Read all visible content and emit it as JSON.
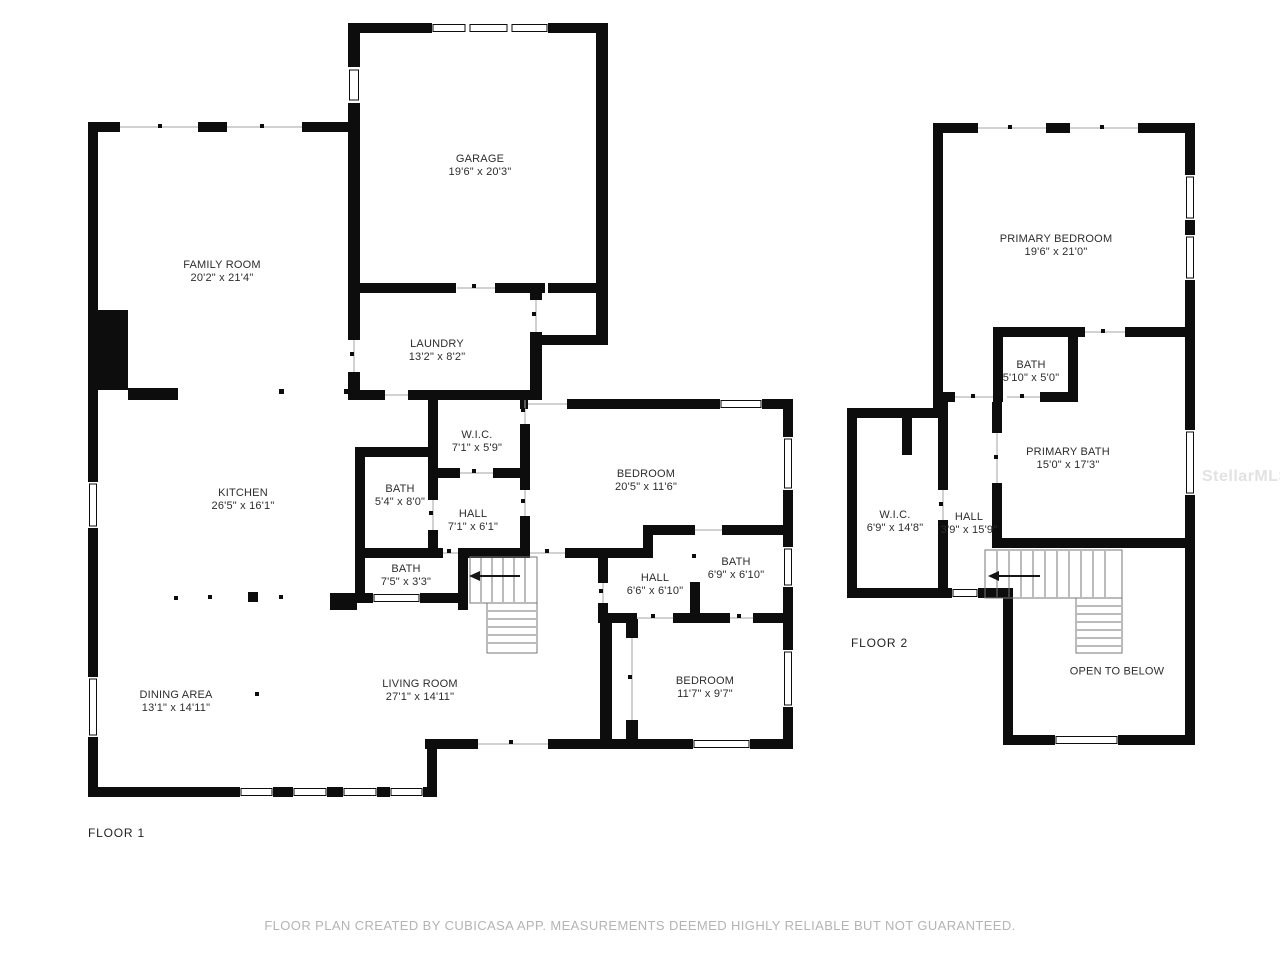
{
  "colors": {
    "wall": "#0d0d0d",
    "thin_line": "#a6a6a6",
    "stair_line": "#777777",
    "label": "#2d2d2d",
    "footer": "#b4b4b4",
    "watermark": "#e2e2e2"
  },
  "watermark": {
    "text": "StellarMLS"
  },
  "footer": {
    "disclaimer": "FLOOR PLAN CREATED BY CUBICASA APP. MEASUREMENTS DEEMED HIGHLY RELIABLE BUT NOT GUARANTEED."
  },
  "floor1": {
    "label": "FLOOR 1",
    "rooms": [
      {
        "id": "garage",
        "name": "GARAGE",
        "dims": "19'6\" x 20'3\"",
        "cx": 480,
        "cy": 166
      },
      {
        "id": "family-room",
        "name": "FAMILY ROOM",
        "dims": "20'2\" x 21'4\"",
        "cx": 222,
        "cy": 272
      },
      {
        "id": "laundry",
        "name": "LAUNDRY",
        "dims": "13'2\" x 8'2\"",
        "cx": 437,
        "cy": 351
      },
      {
        "id": "wic",
        "name": "W.I.C.",
        "dims": "7'1\" x 5'9\"",
        "cx": 477,
        "cy": 442
      },
      {
        "id": "kitchen",
        "name": "KITCHEN",
        "dims": "26'5\" x 16'1\"",
        "cx": 243,
        "cy": 500
      },
      {
        "id": "bath-1",
        "name": "BATH",
        "dims": "5'4\" x 8'0\"",
        "cx": 400,
        "cy": 496
      },
      {
        "id": "hall-1",
        "name": "HALL",
        "dims": "7'1\" x 6'1\"",
        "cx": 473,
        "cy": 521
      },
      {
        "id": "bedroom-1",
        "name": "BEDROOM",
        "dims": "20'5\" x 11'6\"",
        "cx": 646,
        "cy": 481
      },
      {
        "id": "bath-2",
        "name": "BATH",
        "dims": "7'5\" x 3'3\"",
        "cx": 406,
        "cy": 576
      },
      {
        "id": "hall-2",
        "name": "HALL",
        "dims": "6'6\" x 6'10\"",
        "cx": 655,
        "cy": 585
      },
      {
        "id": "bath-3",
        "name": "BATH",
        "dims": "6'9\" x 6'10\"",
        "cx": 736,
        "cy": 569
      },
      {
        "id": "bedroom-2",
        "name": "BEDROOM",
        "dims": "11'7\" x 9'7\"",
        "cx": 705,
        "cy": 688
      },
      {
        "id": "living-room",
        "name": "LIVING ROOM",
        "dims": "27'1\" x 14'11\"",
        "cx": 420,
        "cy": 691
      },
      {
        "id": "dining-area",
        "name": "DINING AREA",
        "dims": "13'1\" x 14'11\"",
        "cx": 176,
        "cy": 702
      }
    ]
  },
  "floor2": {
    "label": "FLOOR 2",
    "rooms": [
      {
        "id": "primary-bedroom",
        "name": "PRIMARY BEDROOM",
        "dims": "19'6\" x 21'0\"",
        "cx": 1056,
        "cy": 246
      },
      {
        "id": "bath-4",
        "name": "BATH",
        "dims": "5'10\" x 5'0\"",
        "cx": 1031,
        "cy": 372
      },
      {
        "id": "primary-bath",
        "name": "PRIMARY BATH",
        "dims": "15'0\" x 17'3\"",
        "cx": 1068,
        "cy": 459
      },
      {
        "id": "wic-2",
        "name": "W.I.C.",
        "dims": "6'9\" x 14'8\"",
        "cx": 895,
        "cy": 522
      },
      {
        "id": "hall-3",
        "name": "HALL",
        "dims": "3'9\" x 15'9\"",
        "cx": 969,
        "cy": 524
      },
      {
        "id": "open-to-below",
        "name": "OPEN TO BELOW",
        "dims": "",
        "cx": 1117,
        "cy": 672
      }
    ]
  }
}
